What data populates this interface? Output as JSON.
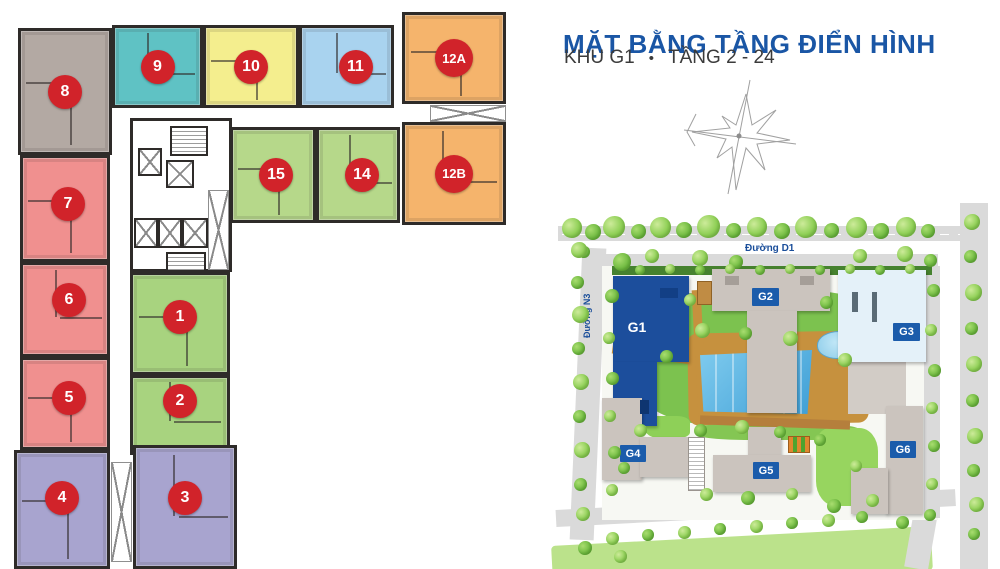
{
  "header": {
    "title": "MẶT BẰNG TẦNG ĐIỂN HÌNH",
    "subtitle_area": "KHU G1",
    "subtitle_bullet": "•",
    "subtitle_floors": "TẦNG 2 - 24",
    "title_color": "#1a56a5",
    "subtitle_color": "#3b3b3b"
  },
  "floorplan": {
    "badge_color": "#d1232a",
    "badge_text_color": "#ffffff",
    "wall_color": "#2e2b29",
    "units": [
      {
        "id": "u1",
        "label": "1",
        "color": "#a8d37f"
      },
      {
        "id": "u2",
        "label": "2",
        "color": "#a8d37f"
      },
      {
        "id": "u3",
        "label": "3",
        "color": "#a8a4cf"
      },
      {
        "id": "u4",
        "label": "4",
        "color": "#a8a4cf"
      },
      {
        "id": "u5",
        "label": "5",
        "color": "#f0908f"
      },
      {
        "id": "u6",
        "label": "6",
        "color": "#f0908f"
      },
      {
        "id": "u7",
        "label": "7",
        "color": "#f0908f"
      },
      {
        "id": "u8",
        "label": "8",
        "color": "#b3a9a3"
      },
      {
        "id": "u9",
        "label": "9",
        "color": "#5fc2c4"
      },
      {
        "id": "u10",
        "label": "10",
        "color": "#f4ee8e"
      },
      {
        "id": "u11",
        "label": "11",
        "color": "#a9d3ef"
      },
      {
        "id": "u12a",
        "label": "12A",
        "color": "#f5b46c"
      },
      {
        "id": "u12b",
        "label": "12B",
        "color": "#f5b46c"
      },
      {
        "id": "u14",
        "label": "14",
        "color": "#b6d88a"
      },
      {
        "id": "u15",
        "label": "15",
        "color": "#b6d88a"
      }
    ]
  },
  "siteplan": {
    "roads": {
      "top": "Đường D1",
      "left": "Đường N3"
    },
    "road_label_color": "#1a4e9a",
    "building_badge_color": "#1b5cab",
    "buildings": [
      {
        "id": "g1",
        "label": "G1",
        "color": "#1c4e9c",
        "style": "plain"
      },
      {
        "id": "g2",
        "label": "G2",
        "color": "#cbc4be",
        "style": "box"
      },
      {
        "id": "g3",
        "label": "G3",
        "color": "#e4f1f9",
        "style": "box"
      },
      {
        "id": "g4",
        "label": "G4",
        "color": "#cbc4be",
        "style": "box"
      },
      {
        "id": "g5",
        "label": "G5",
        "color": "#cbc4be",
        "style": "box"
      },
      {
        "id": "g6",
        "label": "G6",
        "color": "#cbc4be",
        "style": "box"
      }
    ]
  }
}
